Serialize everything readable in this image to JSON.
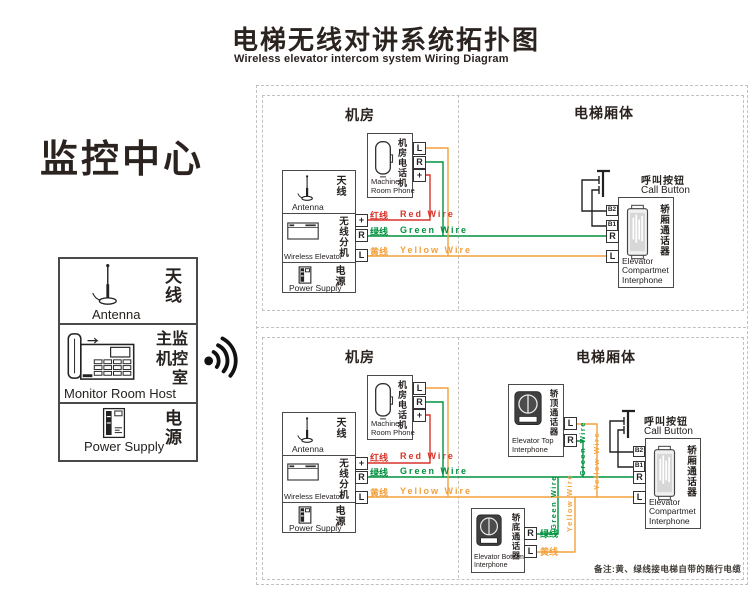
{
  "title": {
    "zh": "电梯无线对讲系统拓扑图",
    "en": "Wireless elevator intercom system Wiring Diagram"
  },
  "monitor_center": {
    "heading": "监控中心",
    "antenna": {
      "zh": "天线",
      "en": "Antenna"
    },
    "host": {
      "zh_lines": [
        "主监",
        "机控",
        "室"
      ],
      "en": "Monitor Room Host"
    },
    "power": {
      "zh": "电源",
      "en": "Power Supply"
    }
  },
  "section_labels": {
    "machine_room": "机房",
    "elevator_body": "电梯厢体"
  },
  "devices": {
    "machine_room_phone": {
      "zh": "机房电话机",
      "en_lines": [
        "Machine",
        "Room Phone"
      ]
    },
    "antenna": {
      "zh": "天线",
      "en": "Antenna"
    },
    "wireless_elevator": {
      "zh": "无线分机",
      "en": "Wireless Elevator"
    },
    "power_supply": {
      "zh": "电源",
      "en": "Power Supply"
    },
    "call_button": {
      "zh": "呼叫按钮",
      "en": "Call Button"
    },
    "compartment_interphone": {
      "zh": "轿厢通话器",
      "en_lines": [
        "Elevator",
        "Compartmet",
        "Interphone"
      ]
    },
    "top_interphone": {
      "zh": "轿顶通话器",
      "en_lines": [
        "Elevator Top",
        "Interphone"
      ]
    },
    "bottom_interphone": {
      "zh": "轿底通话器",
      "en_lines": [
        "Elevator Bottom",
        "Interphone"
      ]
    }
  },
  "terminals": {
    "plus": "+",
    "r": "R",
    "l": "L",
    "b1": "B1",
    "b2": "B2"
  },
  "wires": {
    "red": {
      "zh": "红线",
      "en": "Red Wire",
      "color": "#d9342b"
    },
    "green": {
      "zh": "绿线",
      "en": "Green Wire",
      "color": "#00913f"
    },
    "yellow": {
      "zh": "黄线",
      "en": "Yellow Wire",
      "color": "#f3a13c"
    }
  },
  "note": "备注:黄、绿线接电梯自带的随行电缆"
}
